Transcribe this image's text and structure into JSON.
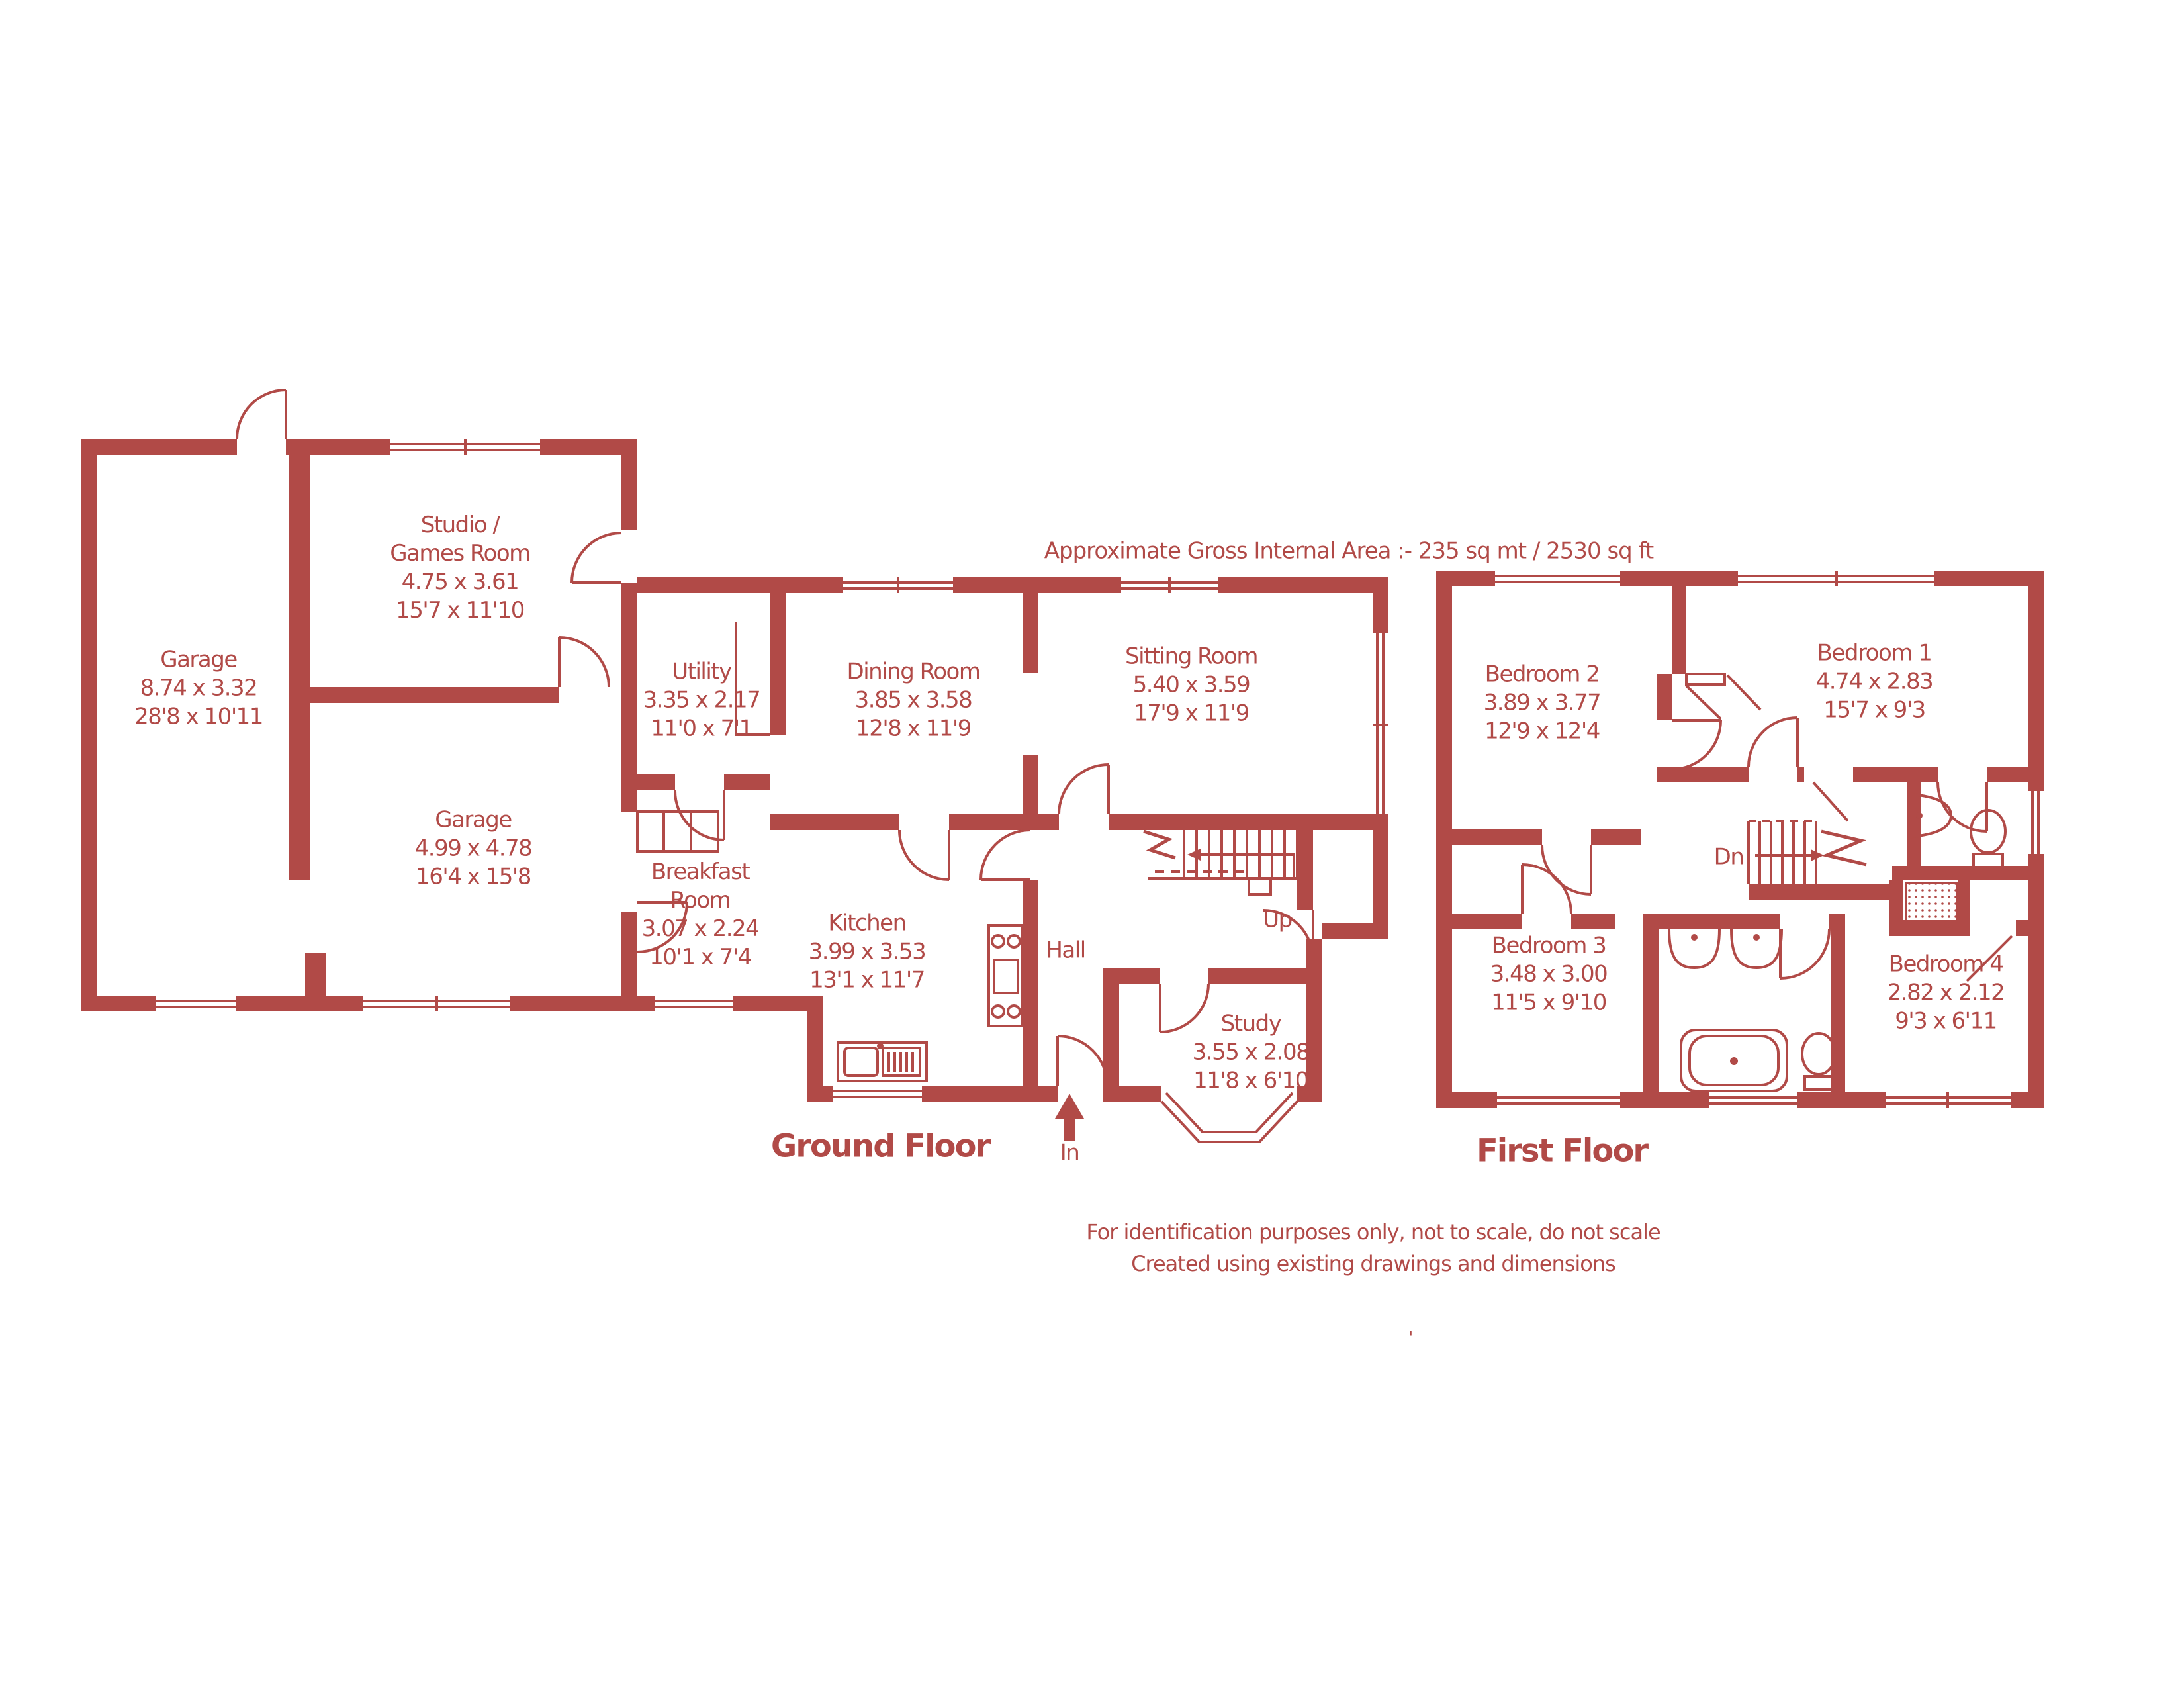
{
  "colors": {
    "accent": "#b14a47"
  },
  "header": {
    "area_label": "Approximate Gross Internal Area  :-    235 sq mt /  2530 sq ft"
  },
  "ground_floor": {
    "title": "Ground Floor",
    "labels": {
      "up": "Up",
      "in": "In"
    },
    "rooms": {
      "garage_long": {
        "name": "Garage",
        "metric": "8.74 x 3.32",
        "imperial": "28'8 x 10'11"
      },
      "studio": {
        "name1": "Studio /",
        "name2": "Games Room",
        "metric": "4.75 x 3.61",
        "imperial": "15'7 x 11'10"
      },
      "garage_square": {
        "name": "Garage",
        "metric": "4.99 x 4.78",
        "imperial": "16'4 x 15'8"
      },
      "utility": {
        "name": "Utility",
        "metric": "3.35 x 2.17",
        "imperial": "11'0 x 7'1"
      },
      "dining": {
        "name": "Dining Room",
        "metric": "3.85 x 3.58",
        "imperial": "12'8 x 11'9"
      },
      "sitting": {
        "name": "Sitting Room",
        "metric": "5.40 x 3.59",
        "imperial": "17'9 x 11'9"
      },
      "breakfast": {
        "name1": "Breakfast",
        "name2": "Room",
        "metric": "3.07 x 2.24",
        "imperial": "10'1 x 7'4"
      },
      "kitchen": {
        "name": "Kitchen",
        "metric": "3.99 x 3.53",
        "imperial": "13'1 x 11'7"
      },
      "hall": {
        "name": "Hall"
      },
      "study": {
        "name": "Study",
        "metric": "3.55 x 2.08",
        "imperial": "11'8 x 6'10"
      }
    }
  },
  "first_floor": {
    "title": "First Floor",
    "labels": {
      "dn": "Dn"
    },
    "rooms": {
      "bedroom1": {
        "name": "Bedroom 1",
        "metric": "4.74 x 2.83",
        "imperial": "15'7 x 9'3"
      },
      "bedroom2": {
        "name": "Bedroom 2",
        "metric": "3.89 x 3.77",
        "imperial": "12'9 x 12'4"
      },
      "bedroom3": {
        "name": "Bedroom 3",
        "metric": "3.48 x 3.00",
        "imperial": "11'5 x 9'10"
      },
      "bedroom4": {
        "name": "Bedroom 4",
        "metric": "2.82 x 2.12",
        "imperial": "9'3 x 6'11"
      }
    }
  },
  "footer": {
    "line1": "For identification purposes only, not to scale, do not scale",
    "line2": "Created using existing drawings and dimensions",
    "mark": "'"
  }
}
